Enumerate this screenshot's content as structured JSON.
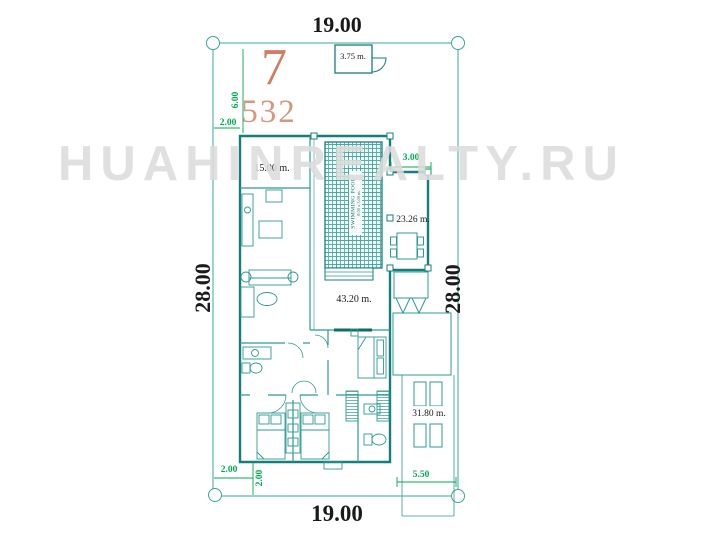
{
  "watermark": "HUAHINREALTY.RU",
  "lot": {
    "width_top": "19.00",
    "width_bottom": "19.00",
    "height_left": "28.00",
    "height_right": "28.00"
  },
  "plot_labels": {
    "house_number": "7",
    "area_number": "532"
  },
  "setbacks": {
    "left_vertical": "6.00",
    "left_horizontal": "2.00",
    "pool_width": "3.00",
    "bottom_left_horizontal": "2.00",
    "bottom_left_vertical": "2.00",
    "bottom_right_driveway": "5.50"
  },
  "rooms": {
    "gatehouse": "3.75 m.",
    "kitchen_wing": "15.00 m.",
    "dining_room": "23.26 m.",
    "living_area": "43.20 m.",
    "carport": "31.80 m."
  },
  "pool": {
    "name": "SWIMMING POOL",
    "size": "8.00 x 3.00 m."
  },
  "colors": {
    "wall_teal": "#157f7a",
    "line_teal": "#3ba49d",
    "dimension_green": "#00a94f",
    "dimension_black": "#1a1a1a",
    "number_salmon": "#ce7e62",
    "area_salmon": "#d8977c",
    "watermark_gray": "#dcdcdc"
  }
}
